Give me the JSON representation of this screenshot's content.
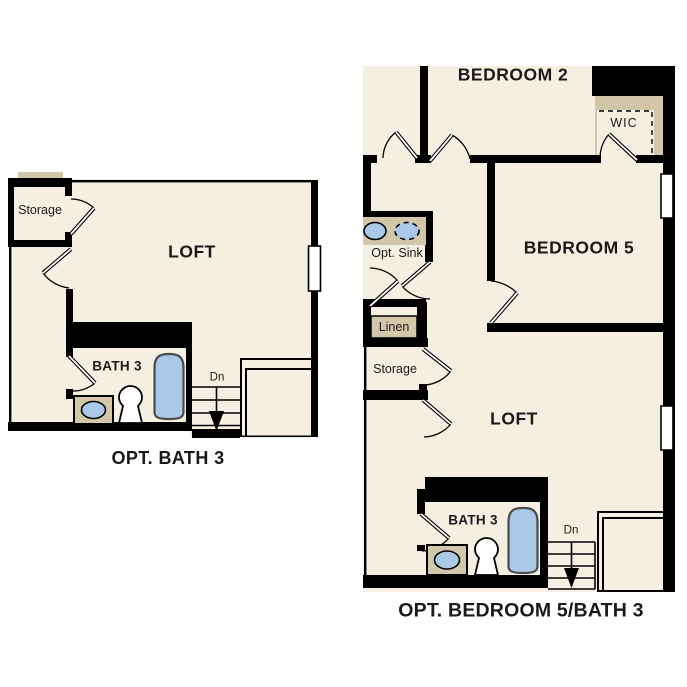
{
  "colors": {
    "floor": "#f5efe2",
    "wall": "#000000",
    "fixture_blue": "#aac8e8",
    "counter_tan": "#d3c7a9",
    "text": "#1a1a1a"
  },
  "left_plan": {
    "caption": "OPT. BATH 3",
    "labels": {
      "storage": "Storage",
      "loft": "LOFT",
      "bath": "BATH 3",
      "stairs_down": "Dn"
    }
  },
  "right_plan": {
    "caption": "OPT. BEDROOM 5/BATH 3",
    "labels": {
      "bedroom2": "BEDROOM 2",
      "wic": "WIC",
      "bedroom5": "BEDROOM 5",
      "opt_sink": "Opt. Sink",
      "linen": "Linen",
      "storage": "Storage",
      "loft": "LOFT",
      "bath": "BATH 3",
      "stairs_down": "Dn"
    }
  }
}
